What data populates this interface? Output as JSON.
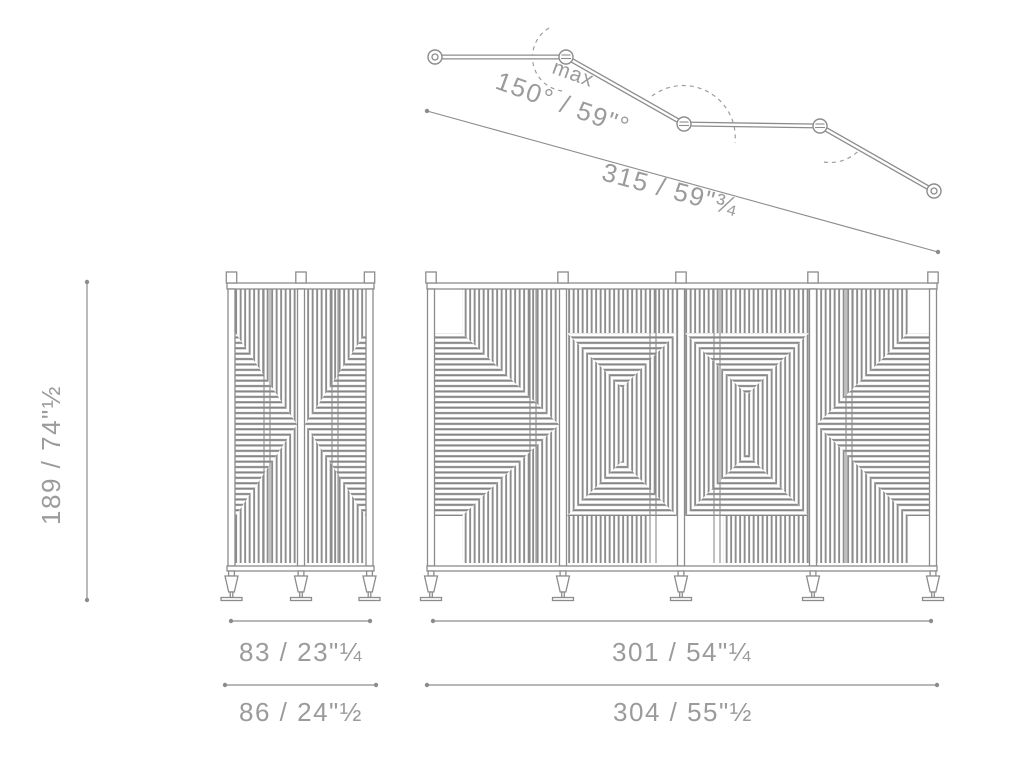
{
  "drawing": {
    "title": "folding screen technical dimension drawing",
    "top_view": {
      "max_label": "max",
      "angle_label": "150° / 59\"°",
      "depth_label": "315 / 59\"¾"
    },
    "height_label": "189 / 74\"½",
    "side_view": {
      "frame_width_label": "83 / 23\"¼",
      "overall_width_label": "86 / 24\"½"
    },
    "front_view": {
      "frame_width_label": "301 / 54\"¼",
      "overall_width_label": "304 / 55\"½"
    }
  },
  "colors": {
    "line": "#8c8c8c",
    "text": "#9b9b9b",
    "stripe_vertical": "#8d8d8d",
    "stripe_horizontal": "#868686"
  }
}
